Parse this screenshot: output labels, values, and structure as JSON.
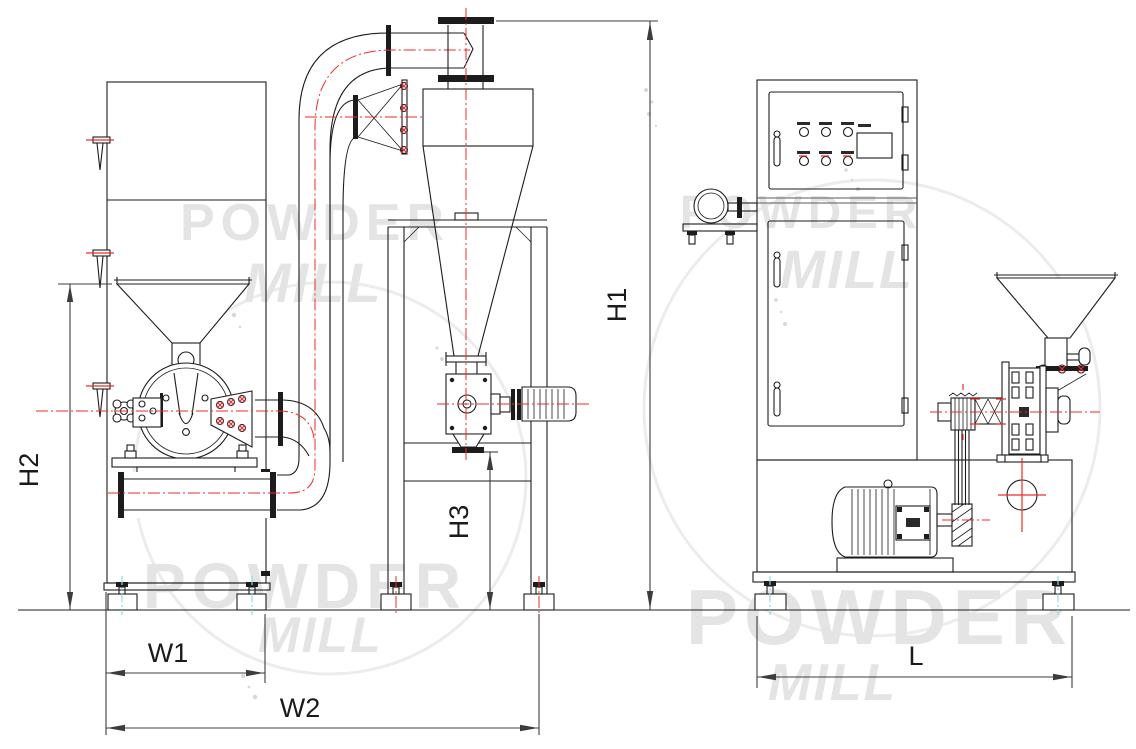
{
  "drawing": {
    "dimensions": {
      "h1": "H1",
      "h2": "H2",
      "h3": "H3",
      "w1": "W1",
      "w2": "W2",
      "l": "L"
    },
    "watermark": {
      "line1": "POWDER",
      "line2": "MILL"
    },
    "colors": {
      "line": "#1c1c1c",
      "centerline_red": "#ef2b2b",
      "foot_centerline_cyan": "#8fd8e6",
      "dimension_line": "#3c3c3c",
      "watermark": "#e4e4e4",
      "background": "#ffffff"
    }
  }
}
